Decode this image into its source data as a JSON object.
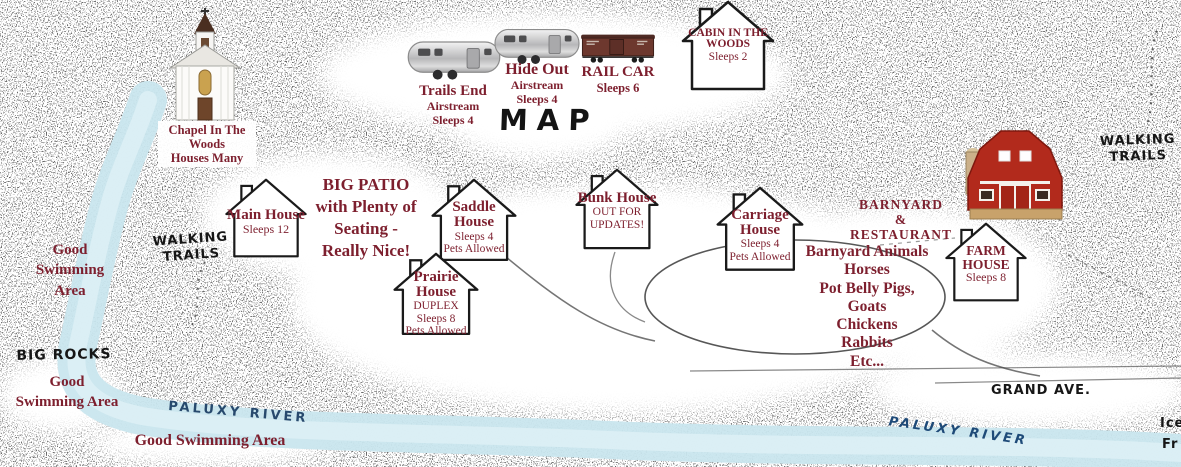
{
  "title": "MAP",
  "colors": {
    "label_maroon": "#7d1f2e",
    "river_blue": "#c9e6ee",
    "river_text_blue": "#1e4a78",
    "ink": "#161616",
    "barn_red": "#b22a1c"
  },
  "chapel": {
    "name": "Chapel In The Woods",
    "note": "Houses Many"
  },
  "trailers": {
    "trails_end": {
      "name": "Trails End",
      "type": "Airstream",
      "sleeps": "Sleeps 4"
    },
    "hide_out": {
      "name": "Hide Out",
      "type": "Airstream",
      "sleeps": "Sleeps 4"
    }
  },
  "railcar": {
    "name": "RAIL CAR",
    "sleeps": "Sleeps 6"
  },
  "houses": {
    "cabin": {
      "name": "CABIN IN THE WOODS",
      "details": [
        "Sleeps 2"
      ]
    },
    "main": {
      "name": "Main House",
      "details": [
        "Sleeps 12"
      ]
    },
    "saddle": {
      "name": "Saddle House",
      "details": [
        "Sleeps 4",
        "Pets Allowed"
      ]
    },
    "prairie": {
      "name": "Prairie House",
      "details": [
        "DUPLEX",
        "Sleeps 8",
        "Pets Allowed"
      ]
    },
    "bunk": {
      "name": "Bunk House",
      "details": [
        "OUT FOR",
        "UPDATES!"
      ]
    },
    "carriage": {
      "name": "Carriage House",
      "details": [
        "Sleeps 4",
        "Pets Allowed"
      ]
    },
    "farm": {
      "name": "FARM HOUSE",
      "details": [
        "Sleeps 8"
      ]
    }
  },
  "notes": {
    "big_patio": {
      "lines": [
        "BIG PATIO",
        "with Plenty of",
        "Seating -",
        "Really Nice!"
      ]
    },
    "barnyard_restaurant": {
      "lines": [
        "BARNYARD",
        "&",
        "RESTAURANT"
      ]
    },
    "barnyard_animals": {
      "lines": [
        "Barnyard Animals",
        "Horses",
        "Pot Belly Pigs,",
        "Goats",
        "Chickens",
        "Rabbits",
        "Etc..."
      ]
    }
  },
  "labels": {
    "walking_trails_left": "WALKING TRAILS",
    "walking_trails_right": "WALKING TRAILS",
    "big_rocks": "BIG ROCKS",
    "grand_ave": "GRAND AVE.",
    "paluxy_river_left": "PALUXY RIVER",
    "paluxy_river_right": "PALUXY RIVER",
    "swimming_upper": "Good Swimming Area",
    "swimming_lower": "Good Swimming Area",
    "swimming_bottom": "Good Swimming Area",
    "edge_partial_top": "Ice",
    "edge_partial_bottom": "Fr"
  }
}
